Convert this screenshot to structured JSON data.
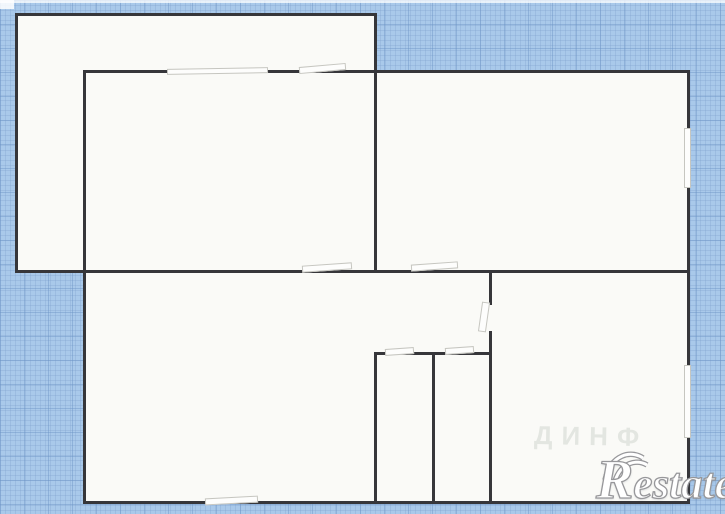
{
  "canvas": {
    "width": 725,
    "height": 514
  },
  "colors": {
    "grid_bg": "#a9c9ea",
    "grid_line_minor": "rgba(125,160,205,0.30)",
    "grid_line_major": "rgba(108,148,198,0.45)",
    "paper": "#fafaf7",
    "wall": "#36363a",
    "opening_border": "#c6c6c0",
    "watermark_outline": "#97979a"
  },
  "floorplan": {
    "rooms": [
      {
        "x": 15,
        "y": 13,
        "w": 359,
        "h": 257
      },
      {
        "x": 83,
        "y": 70,
        "w": 607,
        "h": 434
      }
    ],
    "walls": [
      {
        "x": 15,
        "y": 13,
        "w": 362,
        "h": 3
      },
      {
        "x": 15,
        "y": 13,
        "w": 3,
        "h": 260
      },
      {
        "x": 374,
        "y": 13,
        "w": 3,
        "h": 260
      },
      {
        "x": 83,
        "y": 70,
        "w": 607,
        "h": 3
      },
      {
        "x": 83,
        "y": 70,
        "w": 3,
        "h": 434
      },
      {
        "x": 687,
        "y": 70,
        "w": 3,
        "h": 434
      },
      {
        "x": 83,
        "y": 501,
        "w": 607,
        "h": 3
      },
      {
        "x": 15,
        "y": 270,
        "w": 675,
        "h": 3
      },
      {
        "x": 374,
        "y": 352,
        "w": 3,
        "h": 152
      },
      {
        "x": 432,
        "y": 352,
        "w": 3,
        "h": 152
      },
      {
        "x": 489,
        "y": 270,
        "w": 3,
        "h": 234
      },
      {
        "x": 374,
        "y": 352,
        "w": 118,
        "h": 3
      }
    ],
    "openings": [
      {
        "kind": "window",
        "x": 167,
        "y": 68,
        "w": 101,
        "h": 6,
        "rot": -1
      },
      {
        "kind": "window",
        "x": 299,
        "y": 65,
        "w": 47,
        "h": 7,
        "rot": -5
      },
      {
        "kind": "door",
        "x": 302,
        "y": 264,
        "w": 50,
        "h": 7,
        "rot": -4
      },
      {
        "kind": "door",
        "x": 411,
        "y": 263,
        "w": 47,
        "h": 7,
        "rot": -4
      },
      {
        "kind": "door-gap",
        "x": 489,
        "y": 305,
        "w": 3,
        "h": 26,
        "rot": 0
      },
      {
        "kind": "door",
        "x": 480,
        "y": 302,
        "w": 8,
        "h": 30,
        "rot": 8
      },
      {
        "kind": "door",
        "x": 385,
        "y": 348,
        "w": 29,
        "h": 7,
        "rot": -4
      },
      {
        "kind": "door",
        "x": 445,
        "y": 347,
        "w": 29,
        "h": 7,
        "rot": -4
      },
      {
        "kind": "window",
        "x": 205,
        "y": 497,
        "w": 53,
        "h": 7,
        "rot": -3
      },
      {
        "kind": "window",
        "x": 684,
        "y": 128,
        "w": 7,
        "h": 60,
        "rot": 0
      },
      {
        "kind": "window",
        "x": 684,
        "y": 365,
        "w": 7,
        "h": 73,
        "rot": 0
      }
    ]
  },
  "watermarks": {
    "brand_initial": "R",
    "brand_rest": "estate",
    "faint_text": "ДИНФ"
  }
}
